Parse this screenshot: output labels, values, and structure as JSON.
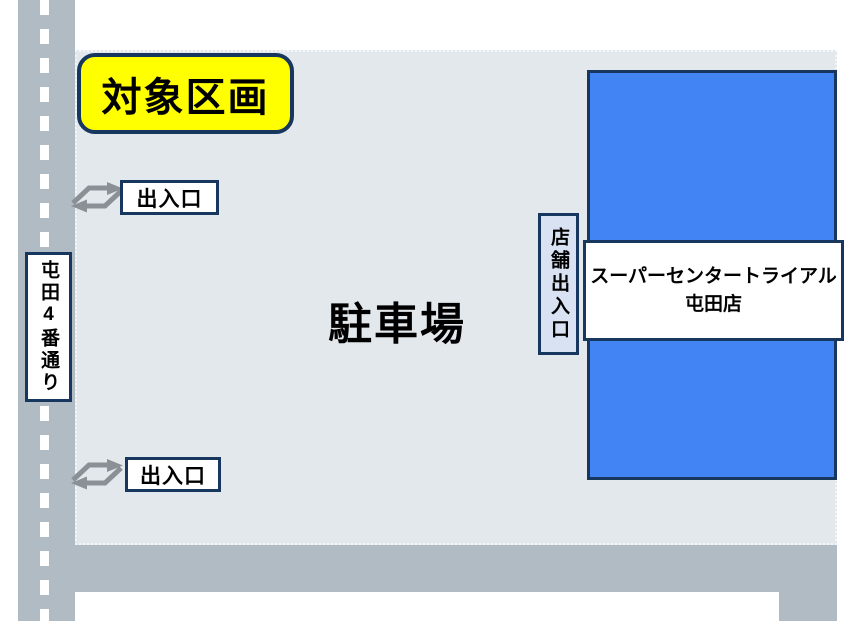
{
  "colors": {
    "navy_border": "#17375E",
    "building_fill": "#4284F3",
    "parking_fill": "#E3E8EC",
    "road_fill": "#B0BBC3",
    "highlight_yellow": "#FFFF00",
    "arrow_gray": "#8A9096",
    "entrance_tab_fill": "#D9E2F3"
  },
  "road": {
    "label": "屯田4番通り"
  },
  "parking": {
    "label": "駐車場"
  },
  "target_badge": {
    "label": "対象区画"
  },
  "entrances": [
    {
      "label": "出入口"
    },
    {
      "label": "出入口"
    }
  ],
  "store_entrance": {
    "label": "店舗出入口"
  },
  "building": {
    "name_line1": "スーパーセンタートライアル",
    "name_line2": "屯田店"
  }
}
